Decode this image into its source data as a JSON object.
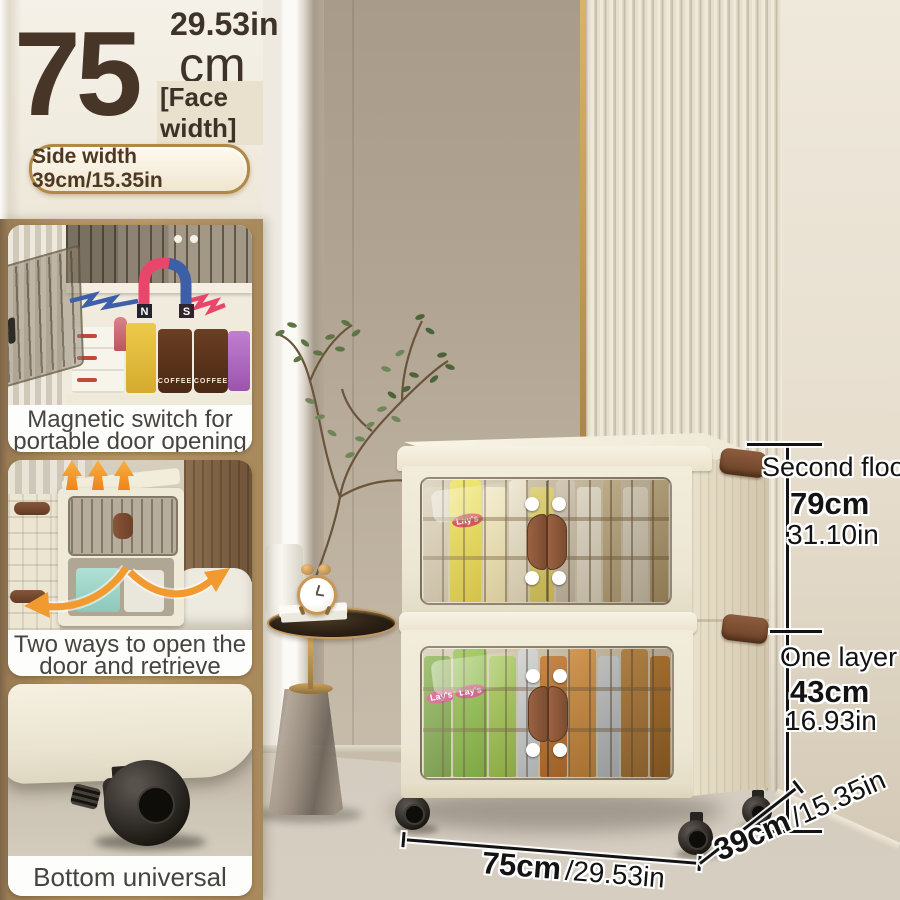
{
  "header": {
    "big_value": "75",
    "unit": "cm",
    "inches": "29.53in",
    "face_width": "[Face width]",
    "side_width": "Side width 39cm/15.35in"
  },
  "features": [
    {
      "caption": [
        "Magnetic switch for",
        "portable door opening"
      ]
    },
    {
      "caption": [
        "Two ways to open the",
        "door and retrieve items"
      ]
    },
    {
      "caption": [
        "Bottom universal pulley"
      ]
    }
  ],
  "magnet": {
    "north": "N",
    "south": "S"
  },
  "packaging": {
    "brand": "Lay's",
    "coffee": "COFFEE"
  },
  "dimensions": {
    "upper": {
      "label": "Second floor",
      "cm": "79cm",
      "inches": "31.10in"
    },
    "lower": {
      "label": "One layer",
      "cm": "43cm",
      "inches": "16.93in"
    },
    "width": {
      "cm": "75cm",
      "inches": "/29.53in"
    },
    "depth": {
      "cm": "39cm",
      "inches": "/15.35in"
    }
  },
  "colors": {
    "accent_tan": "#b2925f",
    "text_brown": "#473627",
    "dim_text": "#131313",
    "magnet_red": "#e8466a",
    "magnet_blue": "#3d5fa8",
    "arrow_orange": "#f09a30",
    "cabinet_ivory": "#f0ead9",
    "handle_brown": "#7b4c30"
  },
  "cabinet_contents": {
    "upper": [
      {
        "w": 4,
        "c1": "#d8cdb2",
        "c2": "#bfb296"
      },
      {
        "w": 5,
        "c1": "#ece04e",
        "c2": "#d2bf36",
        "brand": true,
        "badge": "#d2303a"
      },
      {
        "w": 4,
        "c1": "#f0e8c0",
        "c2": "#ddd19e"
      },
      {
        "w": 3,
        "c1": "#efe9d4",
        "c2": "#d8cfb4"
      },
      {
        "w": 4,
        "c1": "#e4d977",
        "c2": "#cdc054"
      },
      {
        "w": 3,
        "c1": "#d9d2c2",
        "c2": "#beb5a2"
      },
      {
        "w": 4,
        "c1": "#efeadb",
        "c2": "#d9d2c0"
      },
      {
        "w": 3,
        "c1": "#cdbd96",
        "c2": "#b3a179"
      },
      {
        "w": 4,
        "c1": "#e8e2d0",
        "c2": "#cfc8b4"
      },
      {
        "w": 3,
        "c1": "#c9b88e",
        "c2": "#ab9768"
      }
    ],
    "lower": [
      {
        "w": 4,
        "c1": "#7ba83c",
        "c2": "#5f8a2c",
        "brand": true,
        "badge": "#d0487c"
      },
      {
        "w": 5,
        "c1": "#8fbf48",
        "c2": "#6da030",
        "brand": true,
        "badge": "#d0487c"
      },
      {
        "w": 4,
        "c1": "#a5c85c",
        "c2": "#86ab3c"
      },
      {
        "w": 3,
        "c1": "#d4d8da",
        "c2": "#b4bcc2"
      },
      {
        "w": 4,
        "c1": "#c8813c",
        "c2": "#a96426"
      },
      {
        "w": 4,
        "c1": "#db9c50",
        "c2": "#b97c34"
      },
      {
        "w": 3,
        "c1": "#cdd2d6",
        "c2": "#aeb6bd"
      },
      {
        "w": 4,
        "c1": "#c08a46",
        "c2": "#9e6c2e"
      },
      {
        "w": 3,
        "c1": "#b9792f",
        "c2": "#96601f"
      }
    ]
  }
}
